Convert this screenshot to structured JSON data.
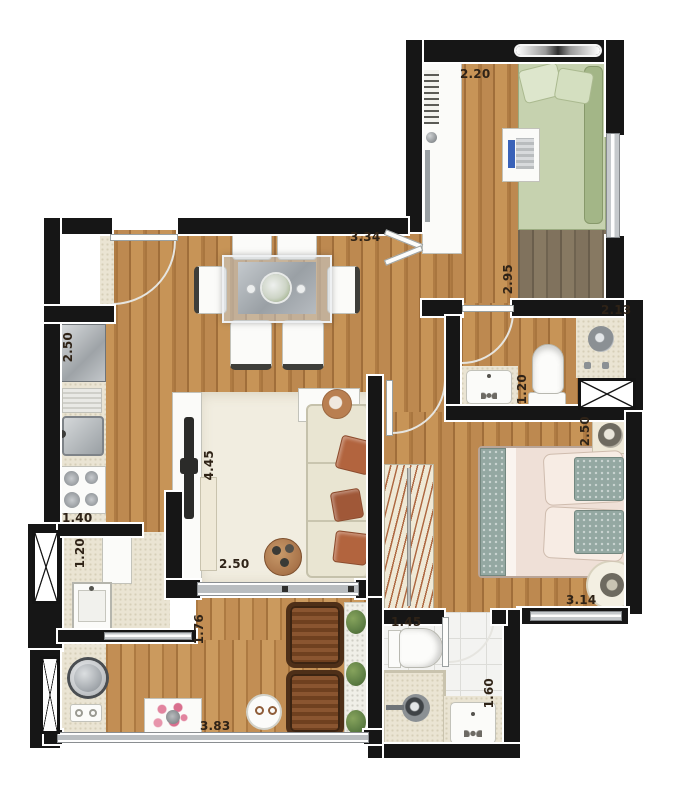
{
  "page": {
    "type": "apartment floor plan",
    "background": "#ffffff"
  },
  "palette": {
    "wall": "#161616",
    "wall-trim": "#f5f5f5",
    "wood": "#b8854e",
    "wood-deep": "#7d6d59",
    "tile": "#eae4d3",
    "tile-white": "#f3f3f1",
    "rug": "#f1ede0",
    "sofa-cream": "#e9e5d2",
    "terracotta": "#b2643e",
    "bed-green": "#c6d2af",
    "bed-green-dark": "#a3b687",
    "bed-blush": "#efe0d7",
    "pillow-teal": "#94a8a2",
    "furniture-white": "#fbfbf9",
    "metal": "#a8adb2",
    "glass": "#c2c6ca",
    "chair-brown": "#7b4a27",
    "plant-green": "#5f7f45",
    "flower-pink": "#e2849f",
    "label": "#2f2317"
  },
  "dimension_labels": [
    {
      "id": "bedroom-top-width",
      "value": "2.20",
      "orientation": "horizontal"
    },
    {
      "id": "bedroom-top-depth",
      "value": "2.95",
      "orientation": "vertical"
    },
    {
      "id": "dining-width",
      "value": "3.34",
      "orientation": "horizontal"
    },
    {
      "id": "bathroom-top-width",
      "value": "2.13",
      "orientation": "horizontal"
    },
    {
      "id": "bathroom-top-depth",
      "value": "1.20",
      "orientation": "vertical"
    },
    {
      "id": "kitchen-length",
      "value": "2.50",
      "orientation": "vertical"
    },
    {
      "id": "kitchen-width",
      "value": "1.40",
      "orientation": "horizontal"
    },
    {
      "id": "laundry-width",
      "value": "1.20",
      "orientation": "vertical"
    },
    {
      "id": "living-length",
      "value": "4.45",
      "orientation": "vertical"
    },
    {
      "id": "living-width",
      "value": "2.50",
      "orientation": "horizontal"
    },
    {
      "id": "master-bedroom-depth",
      "value": "2.50",
      "orientation": "vertical"
    },
    {
      "id": "master-bedroom-width",
      "value": "3.14",
      "orientation": "horizontal"
    },
    {
      "id": "balcony-depth",
      "value": "1.76",
      "orientation": "vertical"
    },
    {
      "id": "balcony-width",
      "value": "3.83",
      "orientation": "horizontal"
    },
    {
      "id": "bathroom-bottom-width",
      "value": "1.45",
      "orientation": "horizontal"
    },
    {
      "id": "bathroom-bottom-depth",
      "value": "1.60",
      "orientation": "vertical"
    }
  ]
}
